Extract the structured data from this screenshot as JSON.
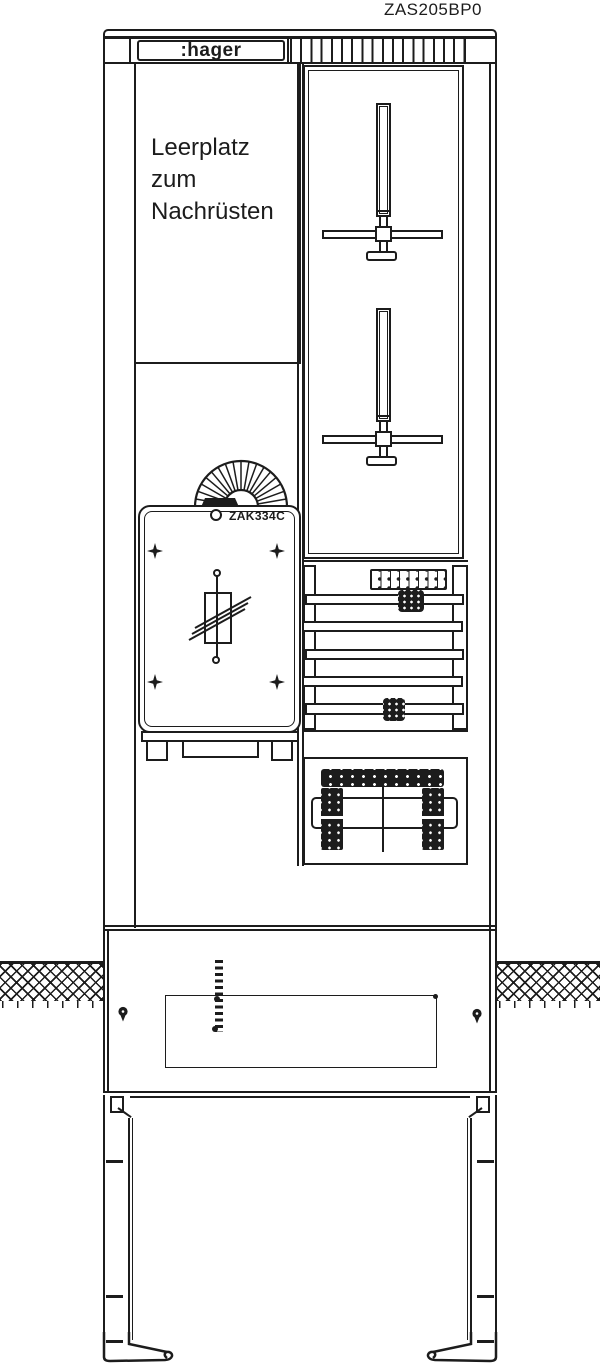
{
  "labels": {
    "product_code": "ZAS205BP0",
    "brand": ":hager",
    "empty_space": {
      "line1": "Leerplatz",
      "line2": "zum",
      "line3": "Nachrüsten"
    },
    "device": "ZAK334C"
  },
  "colors": {
    "line": "#1c1c1c",
    "background": "#ffffff"
  }
}
